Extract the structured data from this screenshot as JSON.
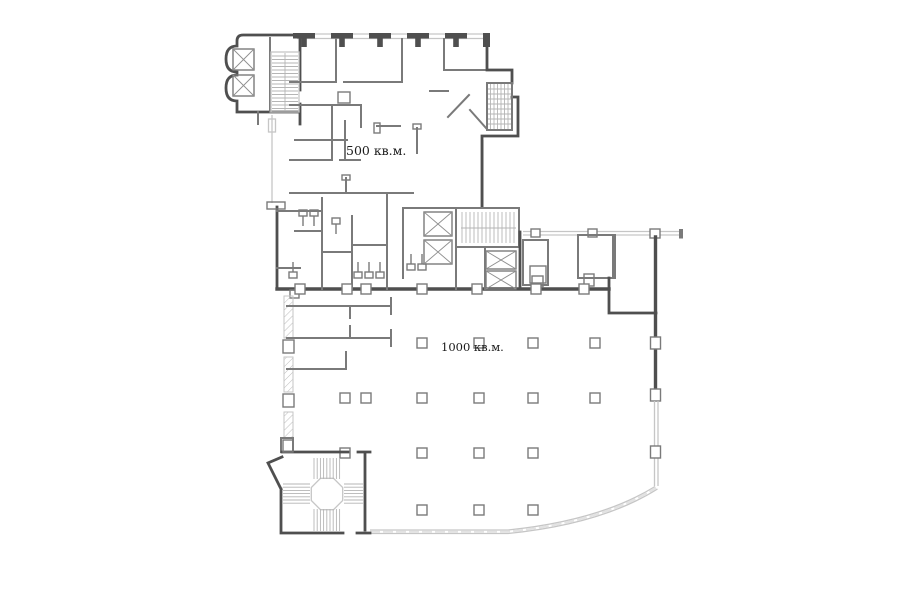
{
  "plan": {
    "area_labels": [
      {
        "id": "upper-area",
        "text": "500 кв.м."
      },
      {
        "id": "lower-area",
        "text": "1000 кв.м."
      }
    ],
    "symbols": [
      {
        "name": "elevator-icon",
        "meaning": "elevator shaft (box with X)",
        "count": 6
      },
      {
        "name": "stair-icon",
        "meaning": "staircase flight (hatched treads)",
        "count": 4
      },
      {
        "name": "column-icon",
        "meaning": "structural column (small square)"
      },
      {
        "name": "toilet-icon",
        "meaning": "WC fixture"
      },
      {
        "name": "curtain-wall-icon",
        "meaning": "glazed facade (thin double line)"
      }
    ],
    "colors": {
      "wall_dark": "#4f4f4f",
      "wall_medium": "#7a7a7a",
      "wall_light": "#c6c6c6",
      "hatch_light": "#b5b5b5",
      "glazing": "#e2e2e2",
      "label_text": "#1b1b1b",
      "background": "#ffffff"
    }
  }
}
